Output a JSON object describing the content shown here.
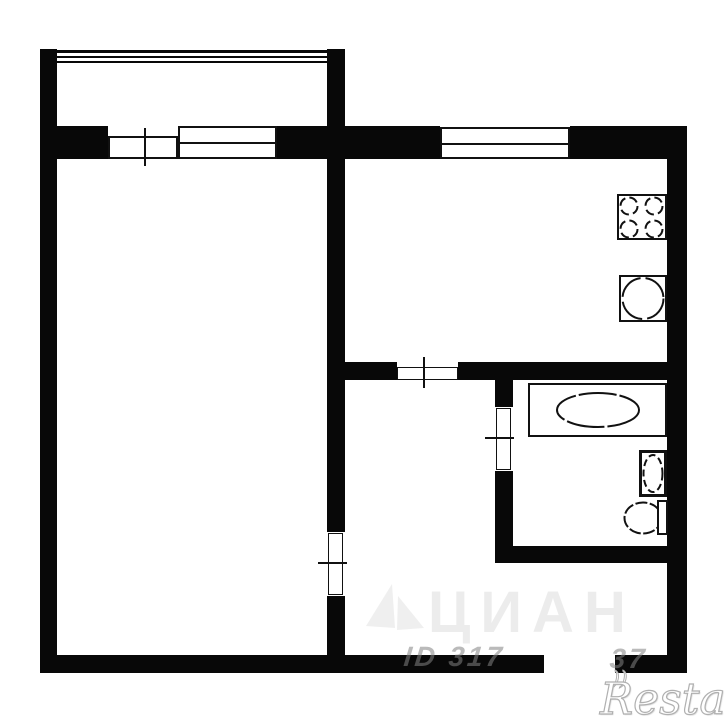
{
  "plan": {
    "type": "apartment-floor-plan",
    "rooms": [
      "balcony",
      "living-room",
      "kitchen",
      "hallway",
      "bathroom"
    ],
    "fixtures": [
      "stove-4-burners",
      "kitchen-sink",
      "bathtub",
      "washbasin",
      "toilet"
    ]
  },
  "colors": {
    "wall": "#080808",
    "background": "#ffffff",
    "line": "#111111",
    "watermark": "#828282",
    "restate_fill": "#ffffff",
    "restate_stroke": "#b0b0b0"
  },
  "watermarks": {
    "cian_text": "ЦИАН",
    "id_left": "ID 317",
    "id_right": "37",
    "agency": "Restate",
    "swash": "))"
  }
}
